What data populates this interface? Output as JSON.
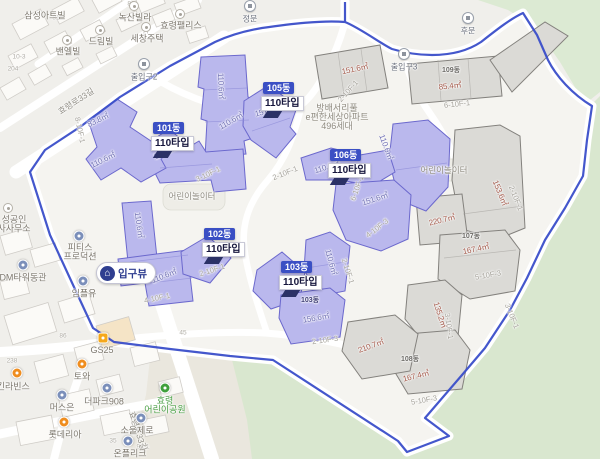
{
  "complex_label": {
    "lines": [
      "방배서리풀",
      "e편한세상아파트",
      "496세대"
    ]
  },
  "entrance_pill": {
    "label": "입구뷰"
  },
  "tooltips": [
    {
      "dong": "101동",
      "type": "110타입",
      "x": 151,
      "y": 118
    },
    {
      "dong": "105동",
      "type": "110타입",
      "x": 261,
      "y": 78
    },
    {
      "dong": "106동",
      "type": "110타입",
      "x": 328,
      "y": 145
    },
    {
      "dong": "102동",
      "type": "110타입",
      "x": 202,
      "y": 224
    },
    {
      "dong": "103동",
      "type": "110타입",
      "x": 279,
      "y": 257
    }
  ],
  "gates": [
    {
      "label": "정문",
      "x": 250,
      "y": 6
    },
    {
      "label": "후문",
      "x": 468,
      "y": 18
    },
    {
      "label": "출입구2",
      "x": 144,
      "y": 64
    },
    {
      "label": "출입구3",
      "x": 404,
      "y": 54
    }
  ],
  "area_labels": [
    {
      "text": "110.6㎡",
      "x": 221,
      "y": 86,
      "rot": 88,
      "tone": "purple"
    },
    {
      "text": "151.6㎡",
      "x": 268,
      "y": 111,
      "rot": -14,
      "tone": "purple"
    },
    {
      "text": "110.6㎡",
      "x": 231,
      "y": 121,
      "rot": -30,
      "tone": "purple"
    },
    {
      "text": "110.6㎡",
      "x": 166,
      "y": 152,
      "rot": -24,
      "tone": "purple"
    },
    {
      "text": "83.8㎡",
      "x": 98,
      "y": 120,
      "rot": -26,
      "tone": "purple"
    },
    {
      "text": "110.6㎡",
      "x": 103,
      "y": 160,
      "rot": -26,
      "tone": "purple"
    },
    {
      "text": "110.6㎡",
      "x": 139,
      "y": 225,
      "rot": 82,
      "tone": "purple"
    },
    {
      "text": "110.6㎡",
      "x": 164,
      "y": 276,
      "rot": -22,
      "tone": "purple"
    },
    {
      "text": "110.6㎡",
      "x": 331,
      "y": 262,
      "rot": 75,
      "tone": "purple"
    },
    {
      "text": "156.6㎡",
      "x": 316,
      "y": 318,
      "rot": -10,
      "tone": "purple"
    },
    {
      "text": "110.6㎡",
      "x": 386,
      "y": 147,
      "rot": 70,
      "tone": "purple"
    },
    {
      "text": "110.6㎡",
      "x": 327,
      "y": 167,
      "rot": -18,
      "tone": "purple"
    },
    {
      "text": "151.6㎡",
      "x": 375,
      "y": 199,
      "rot": -18,
      "tone": "purple"
    },
    {
      "text": "151.6㎡",
      "x": 355,
      "y": 69,
      "rot": -12,
      "tone": "gray"
    },
    {
      "text": "85.4㎡",
      "x": 450,
      "y": 86,
      "rot": -6,
      "tone": "gray"
    },
    {
      "text": "153.6㎡",
      "x": 500,
      "y": 193,
      "rot": 68,
      "tone": "gray"
    },
    {
      "text": "220.7㎡",
      "x": 442,
      "y": 220,
      "rot": -14,
      "tone": "gray"
    },
    {
      "text": "167.4㎡",
      "x": 476,
      "y": 249,
      "rot": -12,
      "tone": "gray"
    },
    {
      "text": "135.2㎡",
      "x": 440,
      "y": 315,
      "rot": 72,
      "tone": "gray"
    },
    {
      "text": "167.4㎡",
      "x": 416,
      "y": 376,
      "rot": -14,
      "tone": "gray"
    },
    {
      "text": "210.7㎡",
      "x": 371,
      "y": 346,
      "rot": -20,
      "tone": "gray"
    }
  ],
  "unit_road_labels": [
    {
      "text": "2-10F-1",
      "x": 348,
      "y": 91,
      "rot": -48
    },
    {
      "text": "6-10F-1",
      "x": 457,
      "y": 104,
      "rot": -6
    },
    {
      "text": "8-10F-1",
      "x": 80,
      "y": 130,
      "rot": 78
    },
    {
      "text": "3-10F-1",
      "x": 208,
      "y": 174,
      "rot": -26
    },
    {
      "text": "2-10F-1",
      "x": 285,
      "y": 173,
      "rot": -22
    },
    {
      "text": "4-10F-1",
      "x": 157,
      "y": 298,
      "rot": -12
    },
    {
      "text": "2-10F-1",
      "x": 212,
      "y": 270,
      "rot": -18
    },
    {
      "text": "2-10F-1",
      "x": 348,
      "y": 271,
      "rot": 72
    },
    {
      "text": "2-10F-3",
      "x": 325,
      "y": 340,
      "rot": -8
    },
    {
      "text": "4-10F-3",
      "x": 377,
      "y": 228,
      "rot": -38
    },
    {
      "text": "6-10F-1",
      "x": 357,
      "y": 188,
      "rot": -70
    },
    {
      "text": "2-10F-1",
      "x": 516,
      "y": 198,
      "rot": 68
    },
    {
      "text": "5-10F-3",
      "x": 488,
      "y": 275,
      "rot": -10
    },
    {
      "text": "3-10F-1",
      "x": 512,
      "y": 316,
      "rot": 68
    },
    {
      "text": "3-10F-1",
      "x": 449,
      "y": 326,
      "rot": 82
    },
    {
      "text": "5-10F-3",
      "x": 424,
      "y": 400,
      "rot": -10
    }
  ],
  "building_numbers": [
    {
      "text": "103동",
      "x": 310,
      "y": 300,
      "tone": "purple"
    },
    {
      "text": "107동",
      "x": 471,
      "y": 236,
      "tone": "gray"
    },
    {
      "text": "108동",
      "x": 410,
      "y": 359,
      "tone": "gray"
    },
    {
      "text": "109동",
      "x": 451,
      "y": 70,
      "tone": "gray"
    }
  ],
  "house_numbers": [
    {
      "text": "83",
      "x": 131,
      "y": 4
    },
    {
      "text": "77",
      "x": 146,
      "y": 32
    },
    {
      "text": "81",
      "x": 56,
      "y": 18
    },
    {
      "text": "10-3",
      "x": 19,
      "y": 57
    },
    {
      "text": "204",
      "x": 13,
      "y": 69
    },
    {
      "text": "45",
      "x": 183,
      "y": 333
    },
    {
      "text": "238",
      "x": 12,
      "y": 361
    },
    {
      "text": "86",
      "x": 63,
      "y": 336
    },
    {
      "text": "35",
      "x": 113,
      "y": 441
    },
    {
      "text": "90-1",
      "x": 143,
      "y": 447
    }
  ],
  "road_names": [
    {
      "text": "효령로33길",
      "x": 76,
      "y": 101,
      "rot": -33
    },
    {
      "text": "효령로33길",
      "x": 138,
      "y": 431,
      "rot": 72
    }
  ],
  "playground_labels": [
    {
      "text": "어린이놀이터",
      "x": 192,
      "y": 196
    },
    {
      "text": "어린이놀이터",
      "x": 444,
      "y": 170
    }
  ],
  "pois": [
    {
      "lines": [
        "삼성아트빌"
      ],
      "x": 45,
      "y": 15,
      "icon": "none"
    },
    {
      "lines": [
        "녹산빌라"
      ],
      "x": 135,
      "y": 17,
      "icon": "dot",
      "ix": 134,
      "iy": 6
    },
    {
      "lines": [
        "효령팰리스"
      ],
      "x": 181,
      "y": 25,
      "icon": "dot",
      "ix": 180,
      "iy": 14
    },
    {
      "lines": [
        "세창주택"
      ],
      "x": 147,
      "y": 38,
      "icon": "dot",
      "ix": 146,
      "iy": 27
    },
    {
      "lines": [
        "드림빌"
      ],
      "x": 101,
      "y": 41,
      "icon": "dot",
      "ix": 100,
      "iy": 30
    },
    {
      "lines": [
        "밴엘빌"
      ],
      "x": 68,
      "y": 51,
      "icon": "dot",
      "ix": 67,
      "iy": 40
    },
    {
      "lines": [
        "성공인",
        "사사무소"
      ],
      "x": 14,
      "y": 219,
      "icon": "dot",
      "ix": 8,
      "iy": 208
    },
    {
      "lines": [
        "피티스",
        "프로덕션"
      ],
      "x": 80,
      "y": 247,
      "icon": "blue",
      "ix": 79,
      "iy": 236
    },
    {
      "lines": [
        "DM타워동관"
      ],
      "x": 23,
      "y": 277,
      "icon": "blue",
      "ix": 23,
      "iy": 265
    },
    {
      "lines": [
        "임플유"
      ],
      "x": 84,
      "y": 293,
      "icon": "blue",
      "ix": 83,
      "iy": 281
    },
    {
      "lines": [
        "GS25"
      ],
      "x": 102,
      "y": 350,
      "icon": "gs",
      "ix": 103,
      "iy": 338
    },
    {
      "lines": [
        "토와"
      ],
      "x": 82,
      "y": 376,
      "icon": "orange",
      "ix": 82,
      "iy": 364
    },
    {
      "lines": [
        "배스킨라빈스"
      ],
      "x": 5,
      "y": 386,
      "icon": "orange",
      "ix": 17,
      "iy": 373
    },
    {
      "lines": [
        "머스은"
      ],
      "x": 62,
      "y": 407,
      "icon": "blue",
      "ix": 62,
      "iy": 395
    },
    {
      "lines": [
        "더파크908"
      ],
      "x": 104,
      "y": 401,
      "icon": "blue",
      "ix": 107,
      "iy": 388
    },
    {
      "lines": [
        "롯데리아"
      ],
      "x": 65,
      "y": 434,
      "icon": "orange",
      "ix": 64,
      "iy": 422
    },
    {
      "lines": [
        "소울제로"
      ],
      "x": 137,
      "y": 430,
      "icon": "blue",
      "ix": 141,
      "iy": 418
    },
    {
      "lines": [
        "온플리크"
      ],
      "x": 130,
      "y": 453,
      "icon": "blue",
      "ix": 128,
      "iy": 441
    },
    {
      "lines": [
        "효령",
        "어린이공원"
      ],
      "x": 165,
      "y": 400,
      "icon": "green",
      "ix": 165,
      "iy": 388,
      "tone": "parktext"
    }
  ],
  "colors": {
    "boundary": "#3a4ec9",
    "selected_building": "#bab8ed",
    "other_building": "#dbdad6",
    "badge": "#3a4fc4",
    "green_area": "#d9e7cf"
  }
}
